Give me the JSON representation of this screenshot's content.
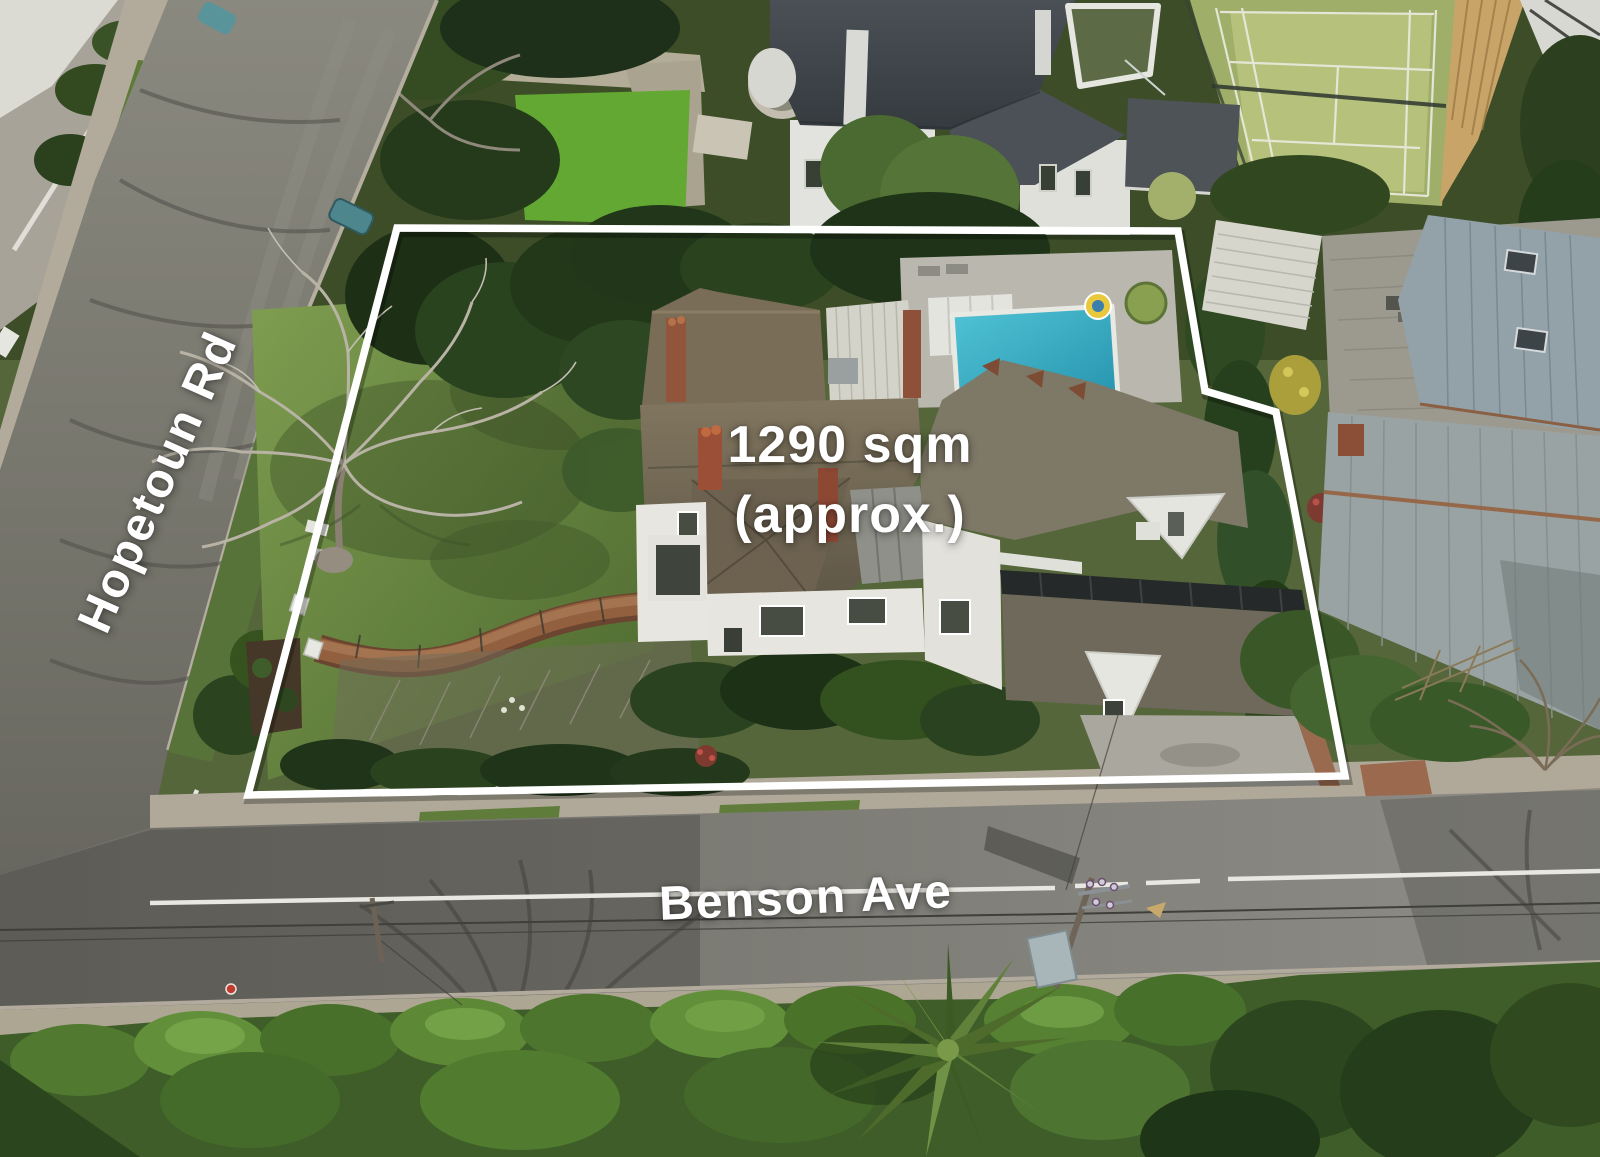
{
  "annotations": {
    "lot_area_line1": "1290 sqm",
    "lot_area_line2": "(approx.)",
    "street_hopetoun": "Hopetoun Rd",
    "street_benson": "Benson Ave",
    "boundary_points": "397,228 1178,231 1205,391 1276,412 1345,776 248,795",
    "boundary_color": "#ffffff"
  },
  "palette": {
    "boundary_white": "#ffffff",
    "pool_turquoise": "#3db4cc",
    "lawn_green": "#6f8c41",
    "hedge_green": "#517a30",
    "road_asphalt": "#807f79",
    "roof_shingle": "#7b705d",
    "mansion_slate": "#41464a",
    "tennis_court": "#abb56f",
    "brick_path": "#93603f"
  }
}
